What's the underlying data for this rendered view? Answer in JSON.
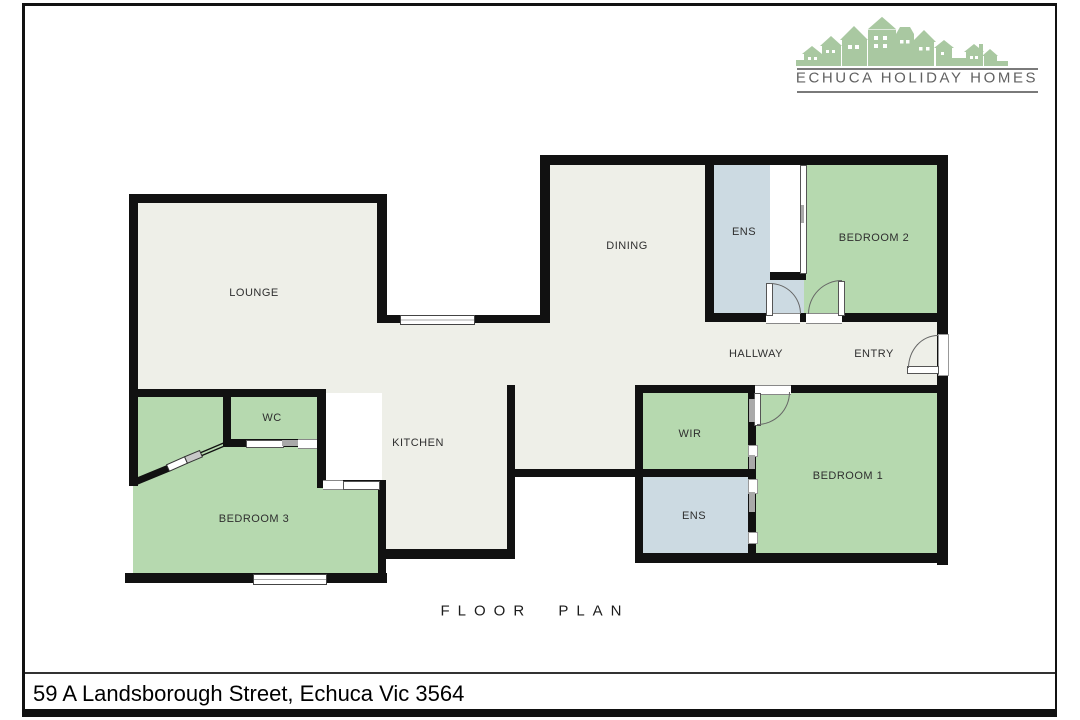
{
  "logo": {
    "name": "ECHUCA HOLIDAY HOMES",
    "icon": "houses-skyline-icon"
  },
  "plan": {
    "title": "FLOOR PLAN",
    "rooms": {
      "lounge": {
        "label": "LOUNGE"
      },
      "dining": {
        "label": "DINING"
      },
      "ens_top": {
        "label": "ENS"
      },
      "bedroom2": {
        "label": "BEDROOM 2"
      },
      "hallway": {
        "label": "HALLWAY"
      },
      "entry": {
        "label": "ENTRY"
      },
      "wc": {
        "label": "WC"
      },
      "kitchen": {
        "label": "KITCHEN"
      },
      "wir": {
        "label": "WIR"
      },
      "bedroom1": {
        "label": "BEDROOM 1"
      },
      "ens_bottom": {
        "label": "ENS"
      },
      "bedroom3": {
        "label": "BEDROOM 3"
      }
    }
  },
  "footer": {
    "address": "59 A Landsborough Street, Echuca Vic 3564"
  },
  "colors": {
    "wall": "#111111",
    "room_green": "#b6d9af",
    "room_blue": "#ccdae2",
    "room_cream": "#eeefe8",
    "logo_green": "#a9c8a1",
    "logo_text": "#616161"
  }
}
